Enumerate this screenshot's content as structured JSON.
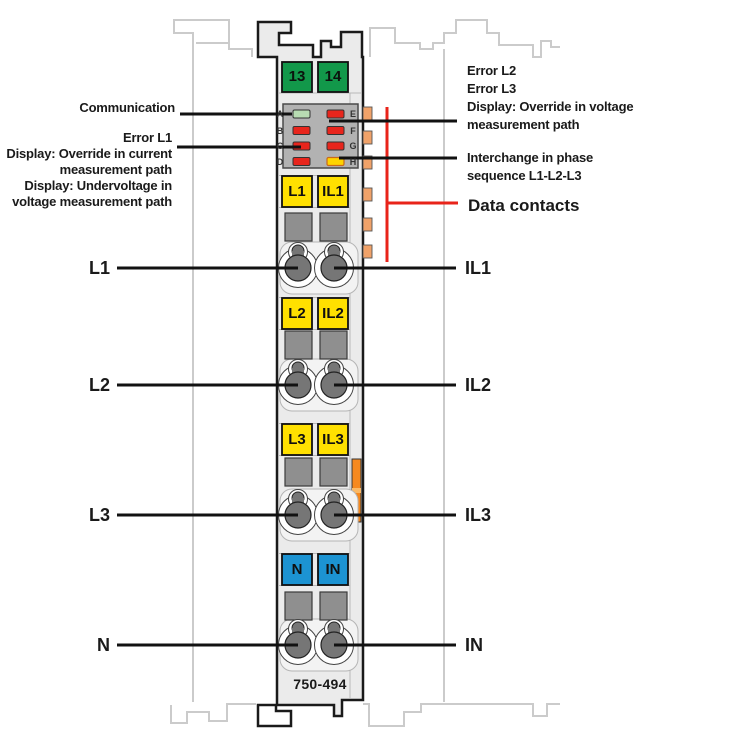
{
  "module": {
    "model": "750-494",
    "power_terminals": [
      "13",
      "14"
    ],
    "led_letters_left": [
      "A",
      "B",
      "C",
      "D"
    ],
    "led_letters_right": [
      "E",
      "F",
      "G",
      "H"
    ],
    "rows": [
      {
        "tag_left": "L1",
        "tag_right": "IL1",
        "label_left": "L1",
        "label_right": "IL1"
      },
      {
        "tag_left": "L2",
        "tag_right": "IL2",
        "label_left": "L2",
        "label_right": "IL2"
      },
      {
        "tag_left": "L3",
        "tag_right": "IL3",
        "label_left": "L3",
        "label_right": "IL3"
      },
      {
        "tag_left": "N",
        "tag_right": "IN",
        "label_left": "N",
        "label_right": "IN"
      }
    ]
  },
  "annotations": {
    "communication": "Communication",
    "left_group": [
      "Error L1",
      "Display: Override in current",
      "measurement path",
      "Display: Undervoltage in",
      "voltage measurement path"
    ],
    "right_group_top": [
      "Error L2",
      "Error L3",
      "Display: Override in voltage",
      "measurement path"
    ],
    "right_group_mid": [
      "Interchange in phase",
      "sequence L1-L2-L3"
    ],
    "data_contacts": "Data contacts"
  },
  "colors": {
    "terminal_green": "#12984a",
    "terminal_yellow": "#ffe000",
    "terminal_blue": "#1c93d2",
    "led_red": "#e8251c",
    "led_green": "#b8dcb2",
    "led_yellow": "#ffd400",
    "contact_orange": "#f0a269",
    "latch_orange": "#f6891f",
    "bracket_red": "#e8231a",
    "module_gray": "#ebebeb"
  }
}
